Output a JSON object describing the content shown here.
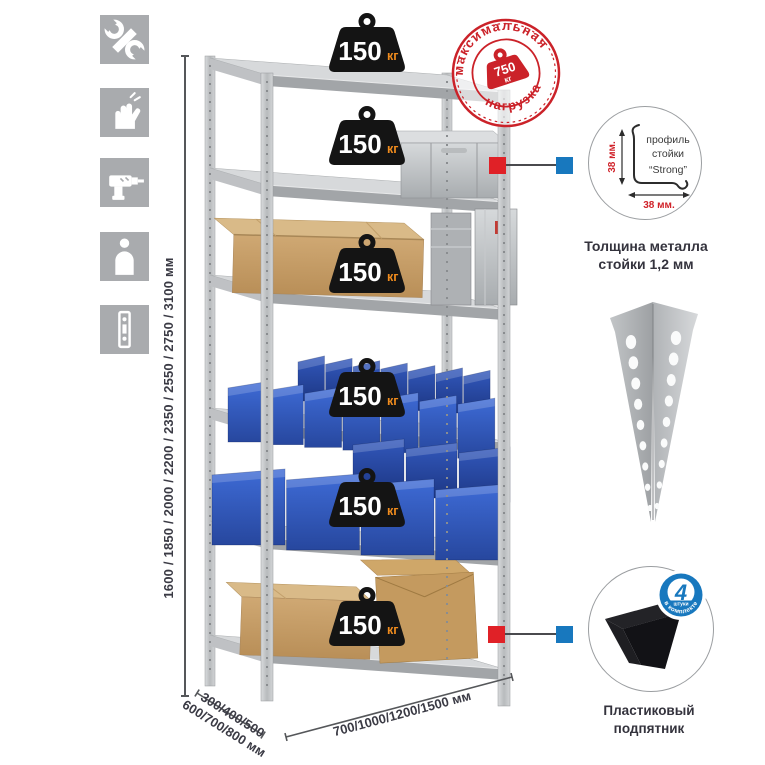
{
  "stamp": {
    "arc_top": "максимальная",
    "arc_bottom": "нагрузка",
    "weight_value": "750",
    "weight_unit": "кг"
  },
  "shelf_badges": [
    {
      "value": "150",
      "unit": "кг"
    },
    {
      "value": "150",
      "unit": "кг"
    },
    {
      "value": "150",
      "unit": "кг"
    },
    {
      "value": "150",
      "unit": "кг"
    },
    {
      "value": "150",
      "unit": "кг"
    },
    {
      "value": "150",
      "unit": "кг"
    }
  ],
  "dimensions": {
    "height": "1600 / 1850 / 2000 / 2200 / 2350 / 2550 / 2750 / 3100 мм",
    "depth_line1": "300/400/500",
    "depth_line2": "600/700/800 мм",
    "width": "700/1000/1200/1500 мм"
  },
  "profile_detail": {
    "label_line1": "профиль",
    "label_line2": "стойки",
    "label_line3": "“Strong”",
    "vertical_dim": "38 мм.",
    "horizontal_dim": "38 мм.",
    "caption_line1": "Толщина металла",
    "caption_line2": "стойки 1,2 мм"
  },
  "foot_detail": {
    "badge_value": "4",
    "badge_sub": "штуки",
    "badge_arc": "в комплекте",
    "caption_line1": "Пластиковый",
    "caption_line2": "подпятник"
  },
  "icons": [
    {
      "name": "wrench"
    },
    {
      "name": "gloves"
    },
    {
      "name": "drill"
    },
    {
      "name": "person"
    },
    {
      "name": "rack-post"
    }
  ],
  "colors": {
    "accent_red": "#d8232a",
    "badge_black": "#141414",
    "unit_orange": "#f08c1e",
    "bin_blue": "#2f5ec4",
    "connector_blue": "#1878be",
    "connector_red": "#e02127",
    "metal_grey": "#c9cbcd",
    "icon_grey": "#a9abae",
    "text_dark": "#3a3a44"
  }
}
